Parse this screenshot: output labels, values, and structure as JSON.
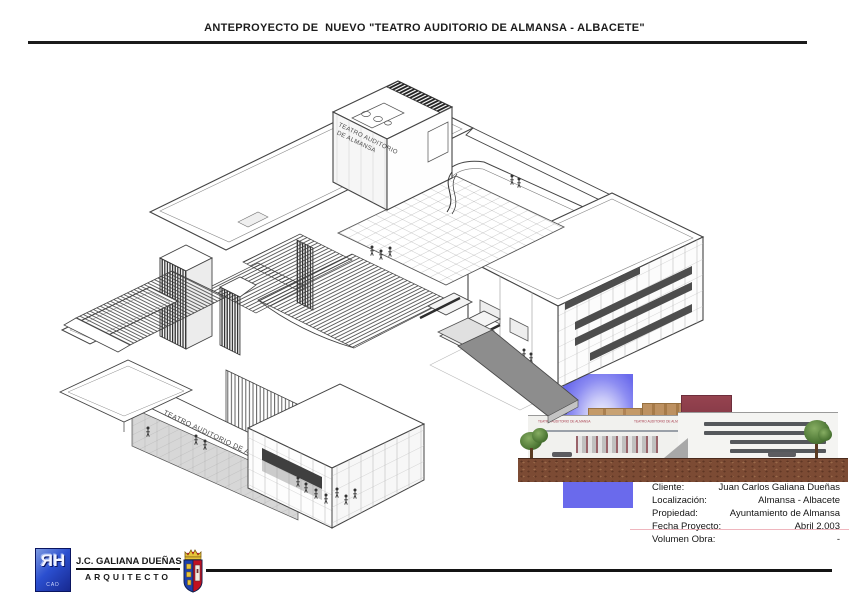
{
  "page": {
    "title": "ANTEPROYECTO DE  NUEVO \"TEATRO AUDITORIO DE ALMANSA - ALBACETE\""
  },
  "drawing": {
    "tower_label_line1": "TEATRO AUDITORIO",
    "tower_label_line2": "DE ALMANSA",
    "facade_label": "TEATRO AUDITORIO DE ALMANSA"
  },
  "inset": {
    "building_label": "TEATRO AUDITORIO DE ALMANSA"
  },
  "project_info": {
    "rows": [
      {
        "label": "Cliente:",
        "value": "Juan Carlos Galiana Dueñas"
      },
      {
        "label": "Localización:",
        "value": "Almansa - Albacete"
      },
      {
        "label": "Propiedad:",
        "value": "Ayuntamiento de Almansa"
      },
      {
        "label": "Fecha Proyecto:",
        "value": "Abril 2.003"
      },
      {
        "label": "Volumen Obra:",
        "value": "-"
      }
    ]
  },
  "footer": {
    "logo_text": "ЯH",
    "logo_sub": "CAD",
    "architect_name": "J.C. GALIANA DUEÑAS",
    "architect_title": "ARQUITECTO"
  },
  "colors": {
    "logo_blue": "#2b4fd0",
    "shield_blue": "#1c3fae",
    "shield_red": "#c01020",
    "sky_blue": "#7d7df0",
    "wood": "#b98a5c",
    "maroon": "#8e3d4f",
    "ground_brown": "#7a4a33",
    "line": "#444444"
  }
}
